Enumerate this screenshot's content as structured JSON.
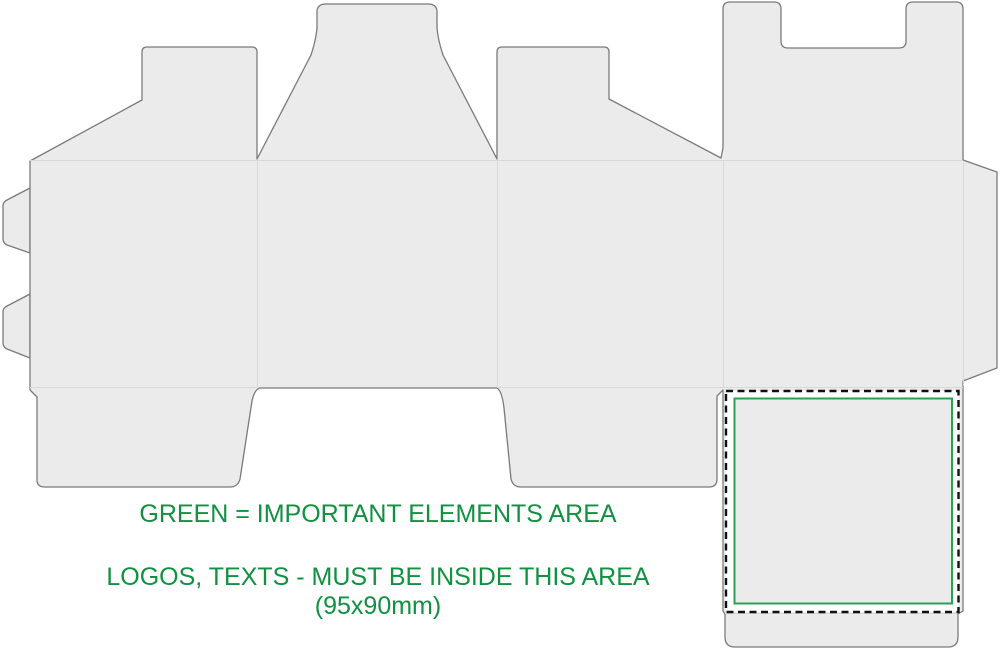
{
  "annotation": {
    "line1": "GREEN = IMPORTANT ELEMENTS AREA",
    "line2": "LOGOS, TEXTS - MUST BE INSIDE THIS AREA",
    "line3": "(95x90mm)"
  },
  "important_area": {
    "size_label": "95x90mm",
    "width_mm": 95,
    "height_mm": 90
  },
  "colors": {
    "background": "#ffffff",
    "panel_fill": "#ebebeb",
    "cut_line": "#7a7a7a",
    "crease_line": "#d8d8d8",
    "dashed_border": "#111111",
    "green_frame": "#2aa153",
    "green_text": "#0f9140"
  }
}
